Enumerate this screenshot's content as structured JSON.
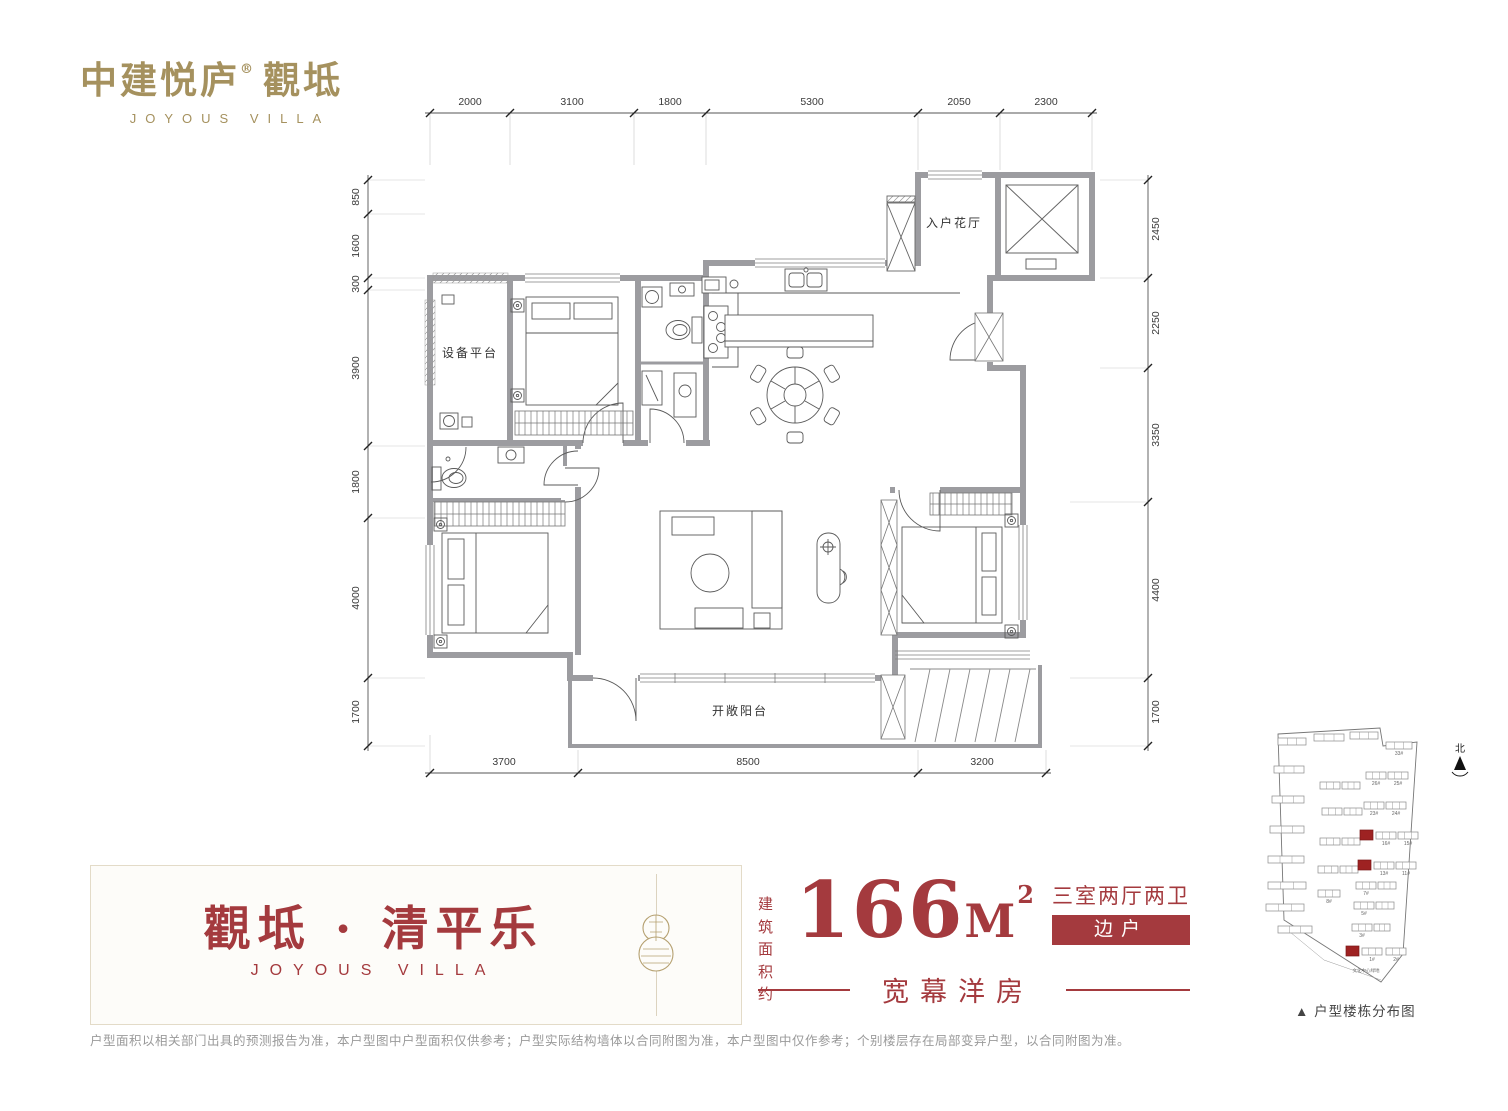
{
  "colors": {
    "brand_gold": "#A5915E",
    "brand_red": "#A43A3E",
    "wall_gray": "#9C9CA0",
    "text_gray": "#9a9a9a"
  },
  "logo": {
    "cn": "中建悦庐",
    "reg": "®",
    "cn2": "觀坻",
    "en": "JOYOUS VILLA"
  },
  "floor_plan": {
    "rooms": [
      {
        "name": "设备平台"
      },
      {
        "name": "入户花厅"
      },
      {
        "name": "开敞阳台"
      }
    ],
    "dimensions": {
      "top": [
        "2000",
        "3100",
        "1800",
        "5300",
        "2050",
        "2300"
      ],
      "bottom": [
        "3700",
        "8500",
        "3200"
      ],
      "left": [
        "850",
        "1600",
        "300",
        "3900",
        "1800",
        "4000",
        "1700"
      ],
      "right": [
        "2450",
        "2250",
        "3350",
        "4400",
        "1700"
      ]
    }
  },
  "banner": {
    "title": "觀坻 · 清平乐",
    "subtitle": "JOYOUS VILLA",
    "area_prefix_line1": "建筑",
    "area_prefix_line2": "面积约",
    "area_value": "166",
    "area_unit": "M",
    "area_sup": "2",
    "layout": "三室两厅两卫",
    "position": "边户",
    "tagline": "宽幕洋房"
  },
  "site_plan": {
    "north_label": "北",
    "caption": "▲ 户型楼栋分布图",
    "green_label": "文化中心绿地",
    "buildings": [
      {
        "x": 16,
        "y": 16,
        "w": 28
      },
      {
        "x": 52,
        "y": 12,
        "w": 30
      },
      {
        "x": 88,
        "y": 10,
        "w": 28
      },
      {
        "x": 124,
        "y": 20,
        "w": 26,
        "l": "33#"
      },
      {
        "x": 12,
        "y": 44,
        "w": 30
      },
      {
        "x": 58,
        "y": 60,
        "w": 20
      },
      {
        "x": 80,
        "y": 60,
        "w": 18
      },
      {
        "x": 104,
        "y": 50,
        "w": 20,
        "l": "26#"
      },
      {
        "x": 126,
        "y": 50,
        "w": 20,
        "l": "25#"
      },
      {
        "x": 10,
        "y": 74,
        "w": 32
      },
      {
        "x": 60,
        "y": 86,
        "w": 20
      },
      {
        "x": 82,
        "y": 86,
        "w": 18
      },
      {
        "x": 102,
        "y": 80,
        "w": 20,
        "l": "23#"
      },
      {
        "x": 124,
        "y": 80,
        "w": 20,
        "l": "24#"
      },
      {
        "x": 8,
        "y": 104,
        "w": 34
      },
      {
        "x": 58,
        "y": 116,
        "w": 20
      },
      {
        "x": 80,
        "y": 116,
        "w": 18
      },
      {
        "x": 98,
        "y": 108,
        "w": 13,
        "r": true
      },
      {
        "x": 114,
        "y": 110,
        "w": 20,
        "l": "16#"
      },
      {
        "x": 136,
        "y": 110,
        "w": 20,
        "l": "15#"
      },
      {
        "x": 6,
        "y": 134,
        "w": 36
      },
      {
        "x": 56,
        "y": 144,
        "w": 20
      },
      {
        "x": 78,
        "y": 144,
        "w": 18
      },
      {
        "x": 96,
        "y": 138,
        "w": 13,
        "r": true
      },
      {
        "x": 112,
        "y": 140,
        "w": 20,
        "l": "13#"
      },
      {
        "x": 134,
        "y": 140,
        "w": 20,
        "l": "11#"
      },
      {
        "x": 6,
        "y": 160,
        "w": 38
      },
      {
        "x": 56,
        "y": 168,
        "w": 22,
        "l": "8#"
      },
      {
        "x": 94,
        "y": 160,
        "w": 20,
        "l": "7#"
      },
      {
        "x": 116,
        "y": 160,
        "w": 18
      },
      {
        "x": 4,
        "y": 182,
        "w": 38
      },
      {
        "x": 92,
        "y": 180,
        "w": 20,
        "l": "5#"
      },
      {
        "x": 114,
        "y": 180,
        "w": 18
      },
      {
        "x": 16,
        "y": 204,
        "w": 34
      },
      {
        "x": 90,
        "y": 202,
        "w": 20,
        "l": "3#"
      },
      {
        "x": 112,
        "y": 202,
        "w": 16
      },
      {
        "x": 84,
        "y": 224,
        "w": 13,
        "r": true
      },
      {
        "x": 100,
        "y": 226,
        "w": 20,
        "l": "1#"
      },
      {
        "x": 124,
        "y": 226,
        "w": 20,
        "l": "2#"
      }
    ]
  },
  "disclaimer": "户型面积以相关部门出具的预测报告为准，本户型图中户型面积仅供参考；户型实际结构墙体以合同附图为准，本户型图中仅作参考；个别楼层存在局部变异户型，以合同附图为准。"
}
